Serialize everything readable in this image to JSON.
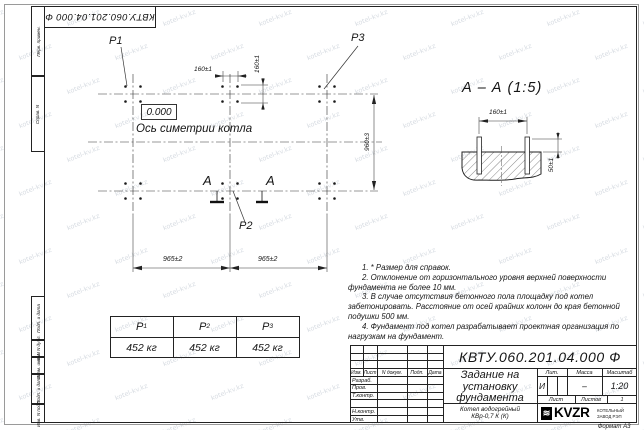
{
  "watermark": {
    "text": "kotel-kv.kz"
  },
  "frame": {
    "stamp_top": "КВТУ.060.201.04.000  Ф",
    "side_top_1": "Перв. примен.",
    "side_top_2": "Справ. N",
    "side_bot_1": "Подп. и дата",
    "side_bot_2": "Инв. N дубл.",
    "side_bot_3": "Взам. инв. N",
    "side_bot_4": "Подп. и дата",
    "side_bot_5": "Инв. N подл.",
    "format_label": "Формат А3"
  },
  "plan": {
    "p1": "P1",
    "p2": "P2",
    "p3": "P3",
    "elevation": "0.000",
    "axis_label": "Ось симетрии котла",
    "section_letter_left": "A",
    "section_letter_right": "A",
    "dim_top_horizontal": "160±1",
    "dim_top_vertical": "160±1",
    "dim_right": "960±3",
    "dim_bottom_left": "965±2",
    "dim_bottom_right": "965±2"
  },
  "section_view": {
    "title": "А – А (1:5)",
    "dim_width": "160±1",
    "dim_height": "50±1"
  },
  "notes": {
    "n1": "1. * Размер для справок.",
    "n2": "2. Отклонение от горизонтального уровня верхней поверхности фундамента не более 10 мм.",
    "n3": "3. В случае отсутствия бетонного пола площадку под котел забетонировать. Расстояние от осей крайних колонн до края бетонной подушки 500 мм.",
    "n4": "4. Фундамент под котел разрабатывает проектная организация по нагрузкам на фундамент."
  },
  "load_table": {
    "h_base_1": "P",
    "h_sub_1": "1",
    "h_base_2": "P",
    "h_sub_2": "2",
    "h_base_3": "P",
    "h_sub_3": "3",
    "v1": "452 кг",
    "v2": "452 кг",
    "v3": "452 кг"
  },
  "title_block": {
    "doc_number": "КВТУ.060.201.04.000  Ф",
    "title_line1": "Задание на",
    "title_line2": "установку",
    "title_line3": "фундамента",
    "product_line1": "Котел водогрейный",
    "product_line2": "КВр-0,7 К (К)",
    "col_izm": "Изм.",
    "col_list": "Лист",
    "col_doc": "N докум.",
    "col_sign": "Подп.",
    "col_date": "Дата",
    "row_razrab": "Разраб.",
    "row_prov": "Пров.",
    "row_tkontr": "Т.контр.",
    "row_nkontr": "Н.контр.",
    "row_utv": "Утв.",
    "lit_label": "Лит.",
    "mass_label": "Масса",
    "scale_label": "Масштаб",
    "lit_value": "И",
    "mass_value": "–",
    "scale_value": "1:20",
    "sheet_label": "Лист",
    "sheets_label": "Листов",
    "sheets_value": "1",
    "logo_wave": "≋",
    "logo_text": "KVZR",
    "logo_sub1": "КОТЕЛЬНЫЙ",
    "logo_sub2": "ЗАВОД РЭП"
  }
}
